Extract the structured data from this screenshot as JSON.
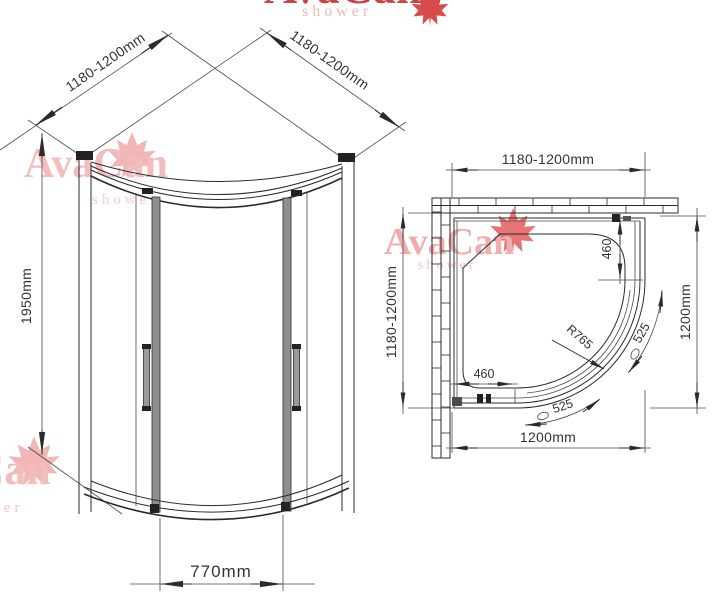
{
  "brand": {
    "name": "AvaCan",
    "tagline": "shower",
    "brand_red": "#cf4040",
    "watermark_pink": "#f2bcbc"
  },
  "iso_view": {
    "dim_width_left": "1180-1200mm",
    "dim_width_right": "1180-1200mm",
    "dim_height": "1950mm",
    "dim_door_opening": "770mm"
  },
  "plan_view": {
    "dim_width_top": "1180-1200mm",
    "dim_depth_left": "1180-1200mm",
    "dim_depth_right": "1200mm",
    "dim_width_bottom": "1200mm",
    "dim_straight_right": "460",
    "dim_straight_bottom": "460",
    "dim_radius": "R765",
    "dim_arc_upper": "525",
    "dim_arc_lower": "525"
  }
}
